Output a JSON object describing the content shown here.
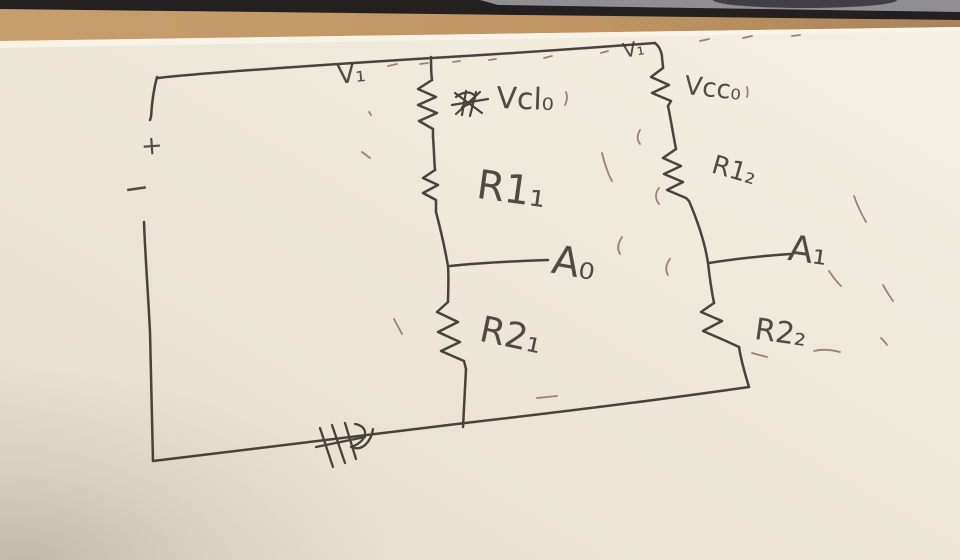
{
  "scene": {
    "paper_color": "#efe9db",
    "ink_color": "#3a352f",
    "desk_wood_color": "#c0986a",
    "laptop_edge_color": "#8f8e92",
    "shadow_band_color": "#242020"
  },
  "source": {
    "plus_sign": "+",
    "minus_sign": "−"
  },
  "labels": {
    "v1_left": "V₁",
    "v1_right": "V₁",
    "branch1_top_resistor": "Vcl₀",
    "branch1_mid_resistor": "R1₁",
    "branch1_tap": "A₀",
    "branch1_bottom_resistor": "R2₁",
    "branch2_top_resistor": "Vcc₀",
    "branch2_mid_resistor": "R1₂",
    "bran2_tap_note": "",
    "branch2_tap": "A₁",
    "branch2_bottom_resistor": "R2₂"
  }
}
